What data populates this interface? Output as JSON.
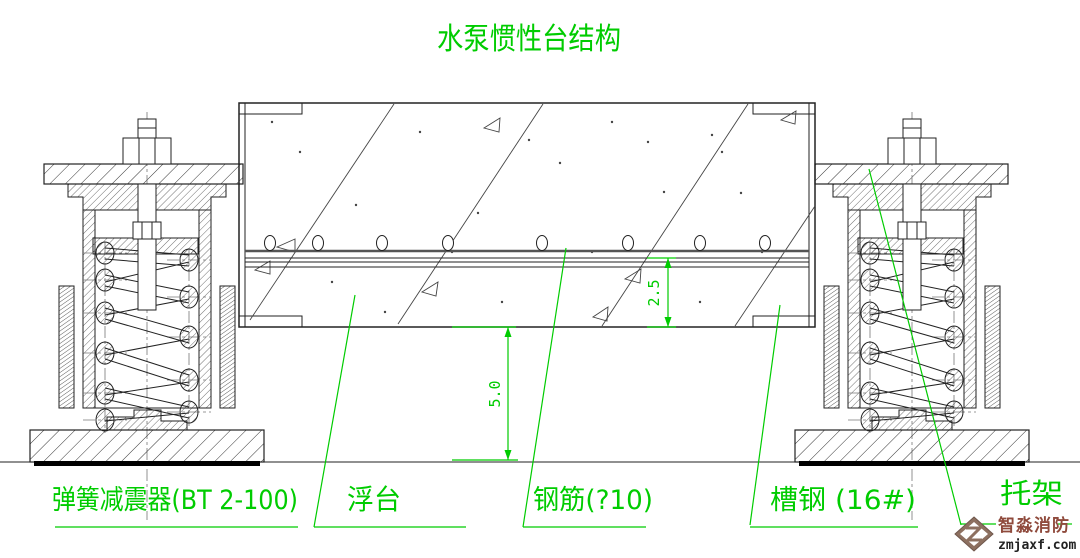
{
  "title": "水泵惯性台结构",
  "labels": {
    "spring_damper": "弹簧减震器(BT 2-100)",
    "floating_platform": "浮台",
    "rebar": "钢筋(?10)",
    "channel_steel": "槽钢 (16#)",
    "bracket": "托架"
  },
  "dimensions": {
    "rebar_depth": "2.5",
    "clearance_height": "5.0"
  },
  "watermark": {
    "company": "智淼消防",
    "website": "zmjaxf.com"
  },
  "colors": {
    "annotation_green": "#00cc00",
    "drawing_line": "#222222",
    "watermark_red": "#8f4a3c",
    "logo_brown": "#8d7060",
    "background": "#ffffff"
  }
}
